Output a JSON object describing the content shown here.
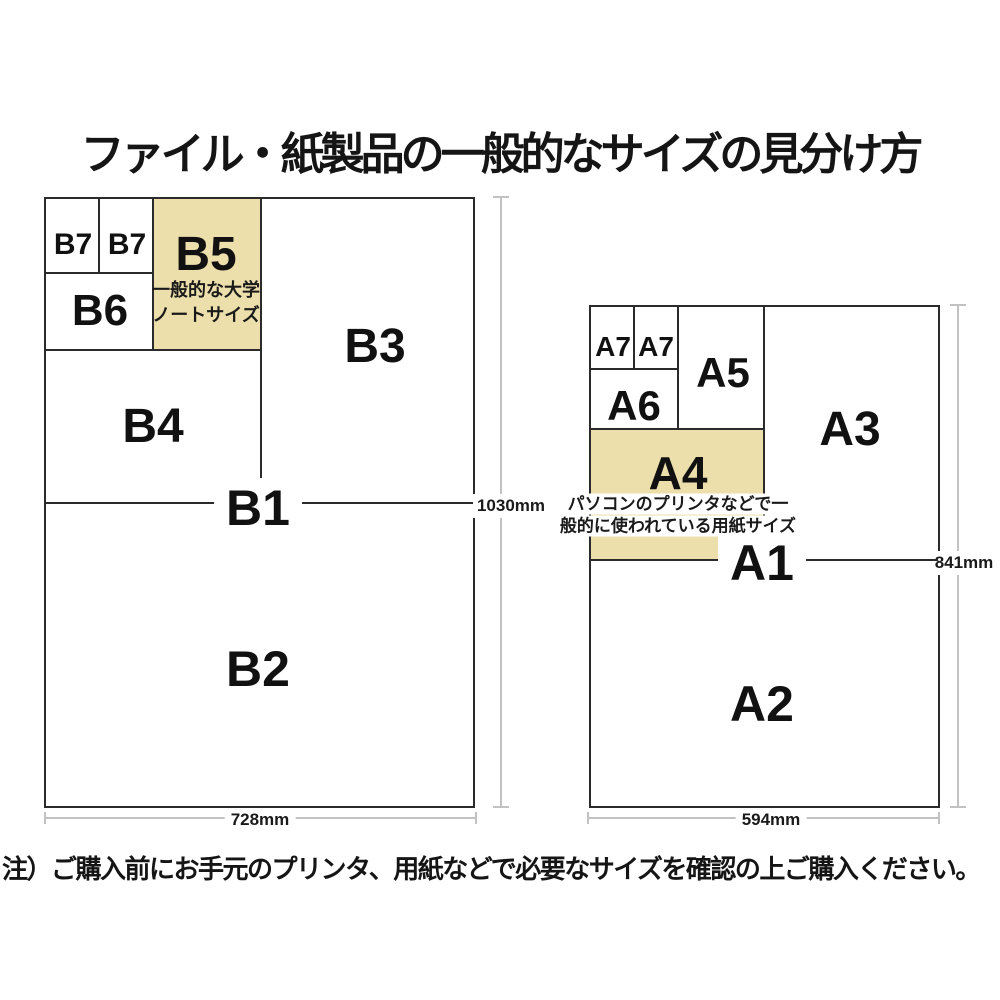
{
  "title": "ファイル・紙製品の一般的なサイズの見分け方",
  "footnote": "注）ご購入前にお手元のプリンタ、用紙などで必要なサイズを確認の上ご購入ください。",
  "colors": {
    "highlight_beige": "#ecdfac",
    "grid_line": "#2b2b2b",
    "dimension_line": "#c2c2c2",
    "text": "#151515"
  },
  "b_diagram": {
    "cells": {
      "b7_left": "B7",
      "b7_right": "B7",
      "b6": "B6",
      "b5": "B5",
      "b4": "B4",
      "b3": "B3",
      "b1": "B1",
      "b2": "B2"
    },
    "b5_caption_line1": "一般的な大学",
    "b5_caption_line2": "ノートサイズ",
    "width_mm": "728mm",
    "height_mm": "1030mm"
  },
  "a_diagram": {
    "cells": {
      "a7_left": "A7",
      "a7_right": "A7",
      "a6": "A6",
      "a5": "A5",
      "a4": "A4",
      "a3": "A3",
      "a1": "A1",
      "a2": "A2"
    },
    "a4_caption_line1": "パソコンのプリンタなどで一",
    "a4_caption_line2": "般的に使われている用紙サイズ",
    "width_mm": "594mm",
    "height_mm": "841mm"
  }
}
